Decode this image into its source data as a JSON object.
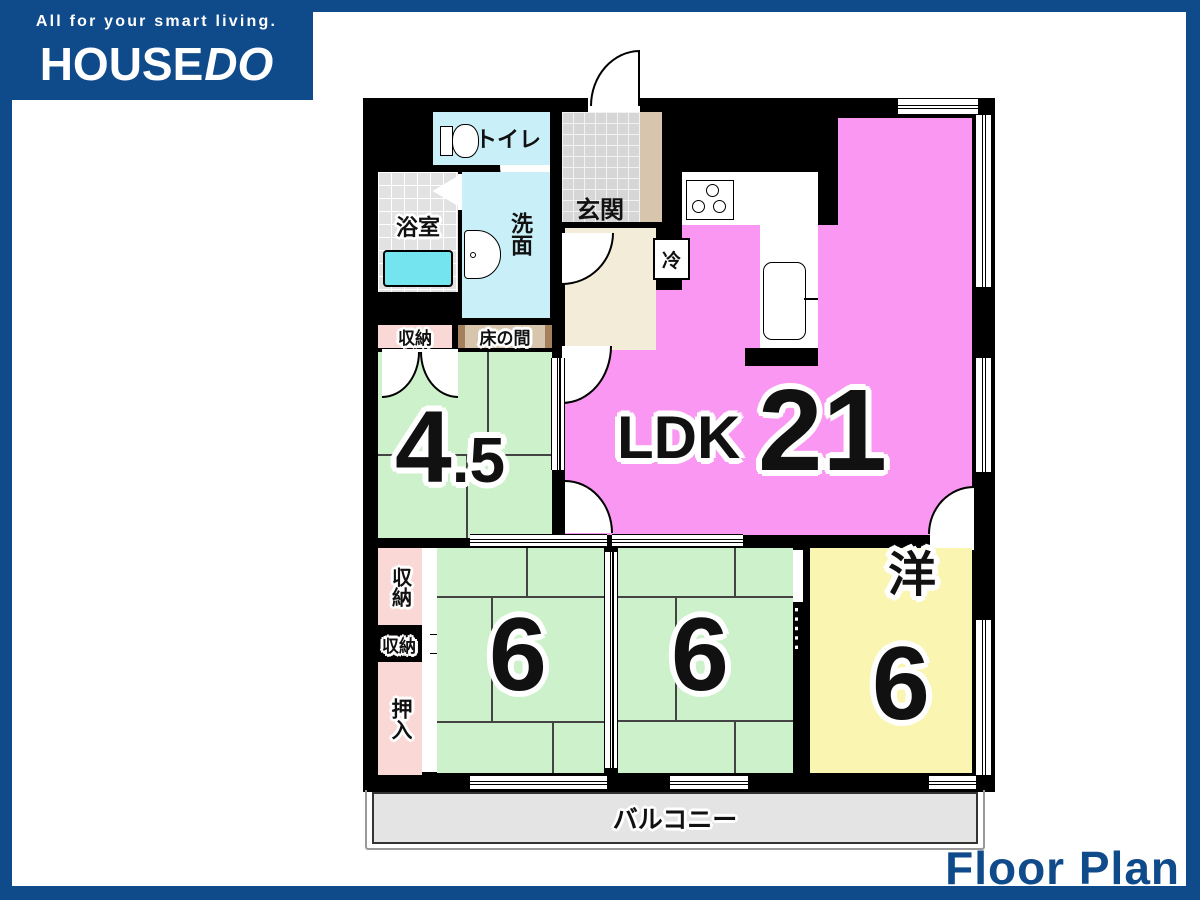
{
  "header": {
    "tagline": "All for your smart living.",
    "brand": {
      "house": "HOUSE",
      "do": "DO"
    }
  },
  "caption": "Floor Plan",
  "floorplan": {
    "rooms": {
      "toilet": "トイレ",
      "entrance": "玄関",
      "bathroom": "浴室",
      "washroom": "洗面",
      "fridge": "冷",
      "storage_top": "収納",
      "tokonoma": "床の間",
      "tatami_45": {
        "whole": "4",
        "fraction": ".5"
      },
      "ldk": {
        "label": "LDK",
        "size": "21"
      },
      "storage_side_upper": "収納",
      "storage_side_lower": "収納",
      "oshiire": "押入",
      "tatami_6_left": "6",
      "tatami_6_center": "6",
      "western": {
        "label": "洋",
        "size": "6"
      },
      "balcony": "バルコニー"
    },
    "colors": {
      "brand_blue": "#0F4A8A",
      "ldk_pink": "#FA97F3",
      "tatami_green": "#CDF2CB",
      "western_yellow": "#FAF6B1",
      "wet_area_cyan": "#C9F0F8",
      "bathtub_cyan": "#74E4EE",
      "hall_cream": "#F2ECD9",
      "closet_pink": "#FAD8D5",
      "tokonoma_tan": "#D7C5AE",
      "balcony_gray": "#E4E4E4",
      "wall_black": "#000000"
    }
  }
}
